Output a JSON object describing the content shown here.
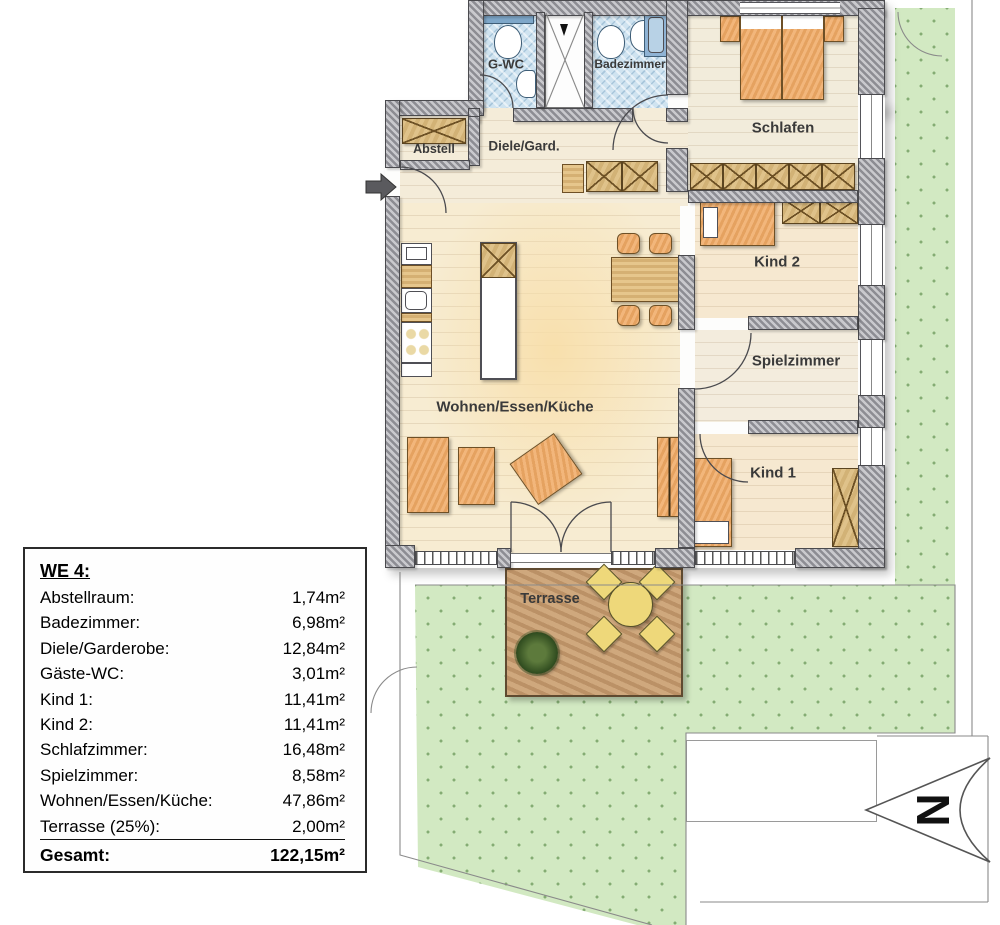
{
  "plan": {
    "labels": {
      "gwc": "G-WC",
      "badezimmer": "Badezimmer",
      "schlafen": "Schlafen",
      "abstell": "Abstell",
      "diele": "Diele/Gard.",
      "kind2": "Kind 2",
      "spielzimmer": "Spielzimmer",
      "kind1": "Kind 1",
      "wohnen": "Wohnen/Essen/Küche",
      "terrasse": "Terrasse"
    },
    "north": "N"
  },
  "legend": {
    "title": "WE 4:",
    "rows": [
      {
        "label": "Abstellraum:",
        "value": "1,74m²"
      },
      {
        "label": "Badezimmer:",
        "value": "6,98m²"
      },
      {
        "label": "Diele/Garderobe:",
        "value": "12,84m²"
      },
      {
        "label": "Gäste-WC:",
        "value": "3,01m²"
      },
      {
        "label": "Kind 1:",
        "value": "11,41m²"
      },
      {
        "label": "Kind 2:",
        "value": "11,41m²"
      },
      {
        "label": "Schlafzimmer:",
        "value": "16,48m²"
      },
      {
        "label": "Spielzimmer:",
        "value": "8,58m²"
      },
      {
        "label": "Wohnen/Essen/Küche:",
        "value": "47,86m²"
      },
      {
        "label": "Terrasse (25%):",
        "value": "2,00m²"
      }
    ],
    "total": {
      "label": "Gesamt:",
      "value": "122,15m²"
    }
  },
  "colors": {
    "wall": "#94949a",
    "floor": "#f4ecd9",
    "bath_floor": "#cfe3f0",
    "lawn": "#d2e9c2",
    "lawn_dot": "#84ac73",
    "terrace_wood": "#c8a175",
    "furniture": "#efb277",
    "wardrobe": "#d9bc83",
    "terrace_furniture": "#eed87a",
    "label_text": "#3a3a3a"
  }
}
